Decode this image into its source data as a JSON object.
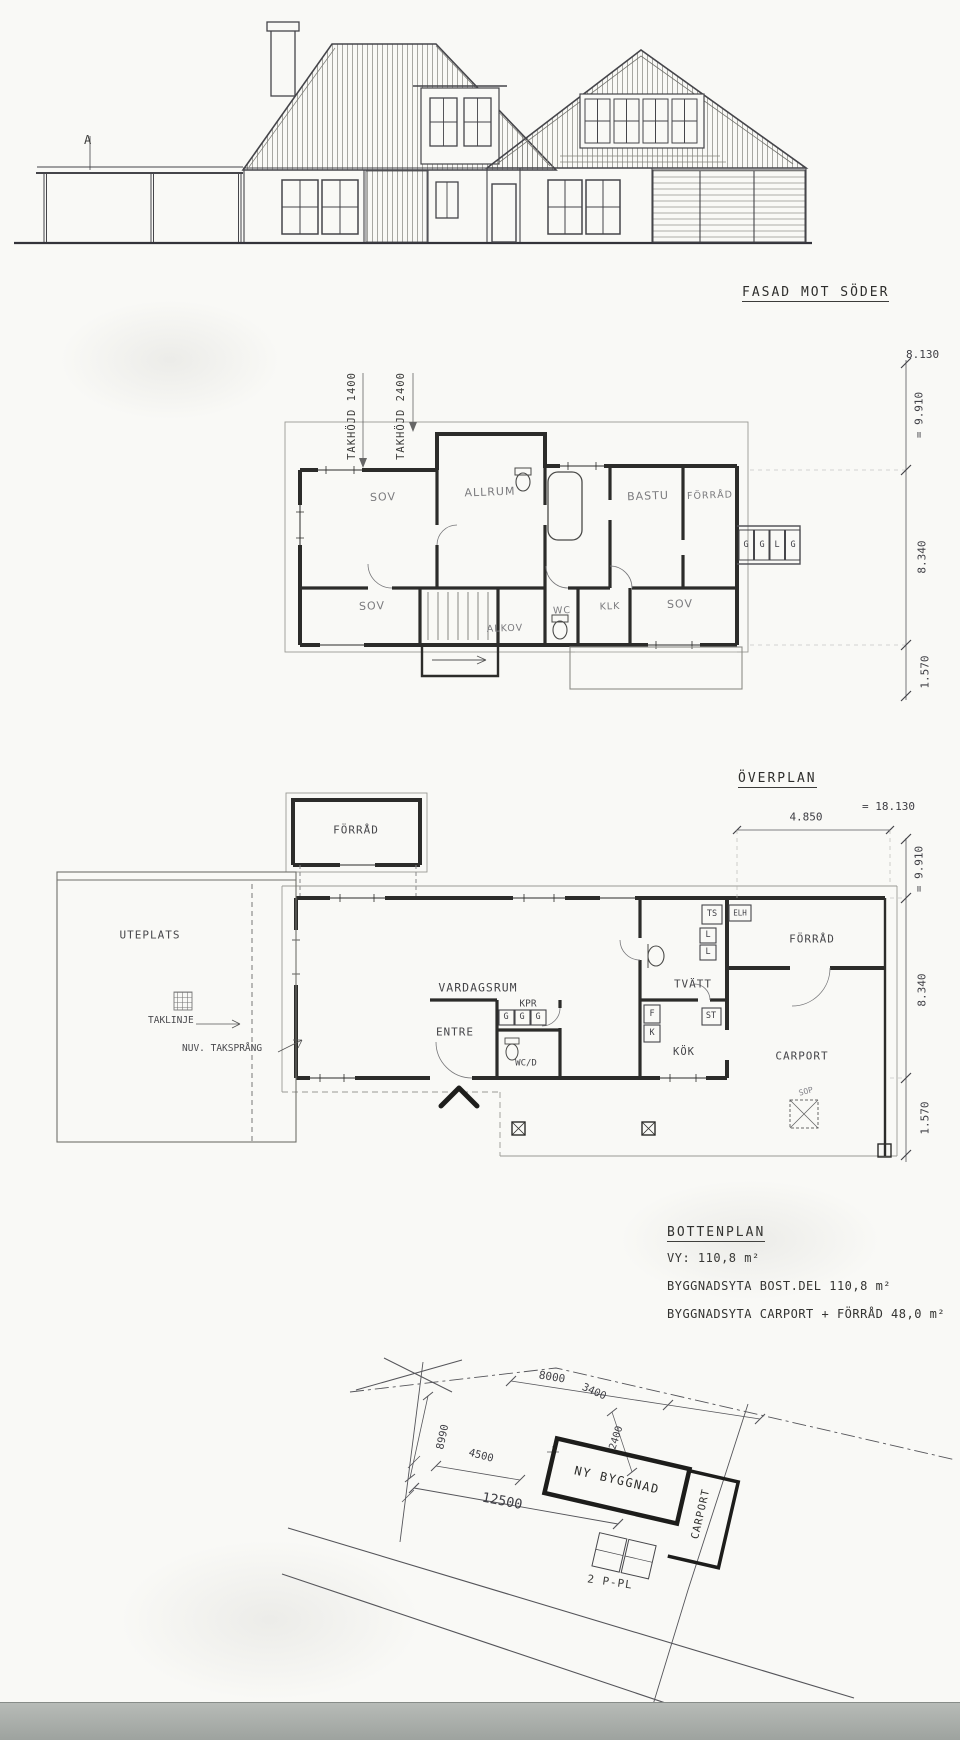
{
  "elevation": {
    "title": "FASAD MOT SÖDER",
    "marker": "A"
  },
  "overplan": {
    "title": "ÖVERPLAN",
    "takhojd1": "TAKHÖJD 1400",
    "takhojd2": "TAKHÖJD 2400",
    "rooms": {
      "sov1": "SOV",
      "allrum": "ALLRUM",
      "bastu": "BASTU",
      "forrad": "FÖRRÅD",
      "sov2": "SOV",
      "alkov": "ALKOV",
      "wc": "WC",
      "klk": "KLK",
      "sov3": "SOV"
    },
    "closets": [
      "G",
      "G",
      "L",
      "G"
    ],
    "dims": {
      "width": "8.130",
      "d1": "= 9.910",
      "d2": "8.340",
      "d3": "1.570"
    }
  },
  "bottenplan": {
    "title": "BOTTENPLAN",
    "rooms": {
      "forrad_out": "FÖRRÅD",
      "uteplats": "UTEPLATS",
      "vardagsrum": "VARDAGSRUM",
      "tvatt": "TVÄTT",
      "forrad": "FÖRRÅD",
      "kok": "KÖK",
      "entre": "ENTRE",
      "kpr": "KPR",
      "wcd": "WC/D",
      "carport": "CARPORT"
    },
    "annotations": {
      "taklinje": "TAKLINJE",
      "taksprang": "NUV. TAKSPRÅNG",
      "sop": "SOP"
    },
    "units": {
      "ts": "TS",
      "elh": "ELH",
      "l1": "L",
      "l2": "L",
      "f": "F",
      "k": "K",
      "st": "ST",
      "g1": "G",
      "g2": "G",
      "g3": "G"
    },
    "dims": {
      "carport": "4.850",
      "total": "= 18.130",
      "d1": "= 9.910",
      "d2": "8.340",
      "d3": "1.570"
    },
    "stats": [
      "VY: 110,8 m²",
      "BYGGNADSYTA BOST.DEL 110,8 m²",
      "BYGGNADSYTA CARPORT + FÖRRÅD 48,0 m²"
    ]
  },
  "siteplan": {
    "building": "NY BYGGNAD",
    "carport": "CARPORT",
    "parking": "2 P-PL",
    "dims": {
      "a": "8000",
      "b": "3400",
      "c": "2400",
      "d": "8990",
      "e": "4500",
      "f": "12500"
    }
  }
}
